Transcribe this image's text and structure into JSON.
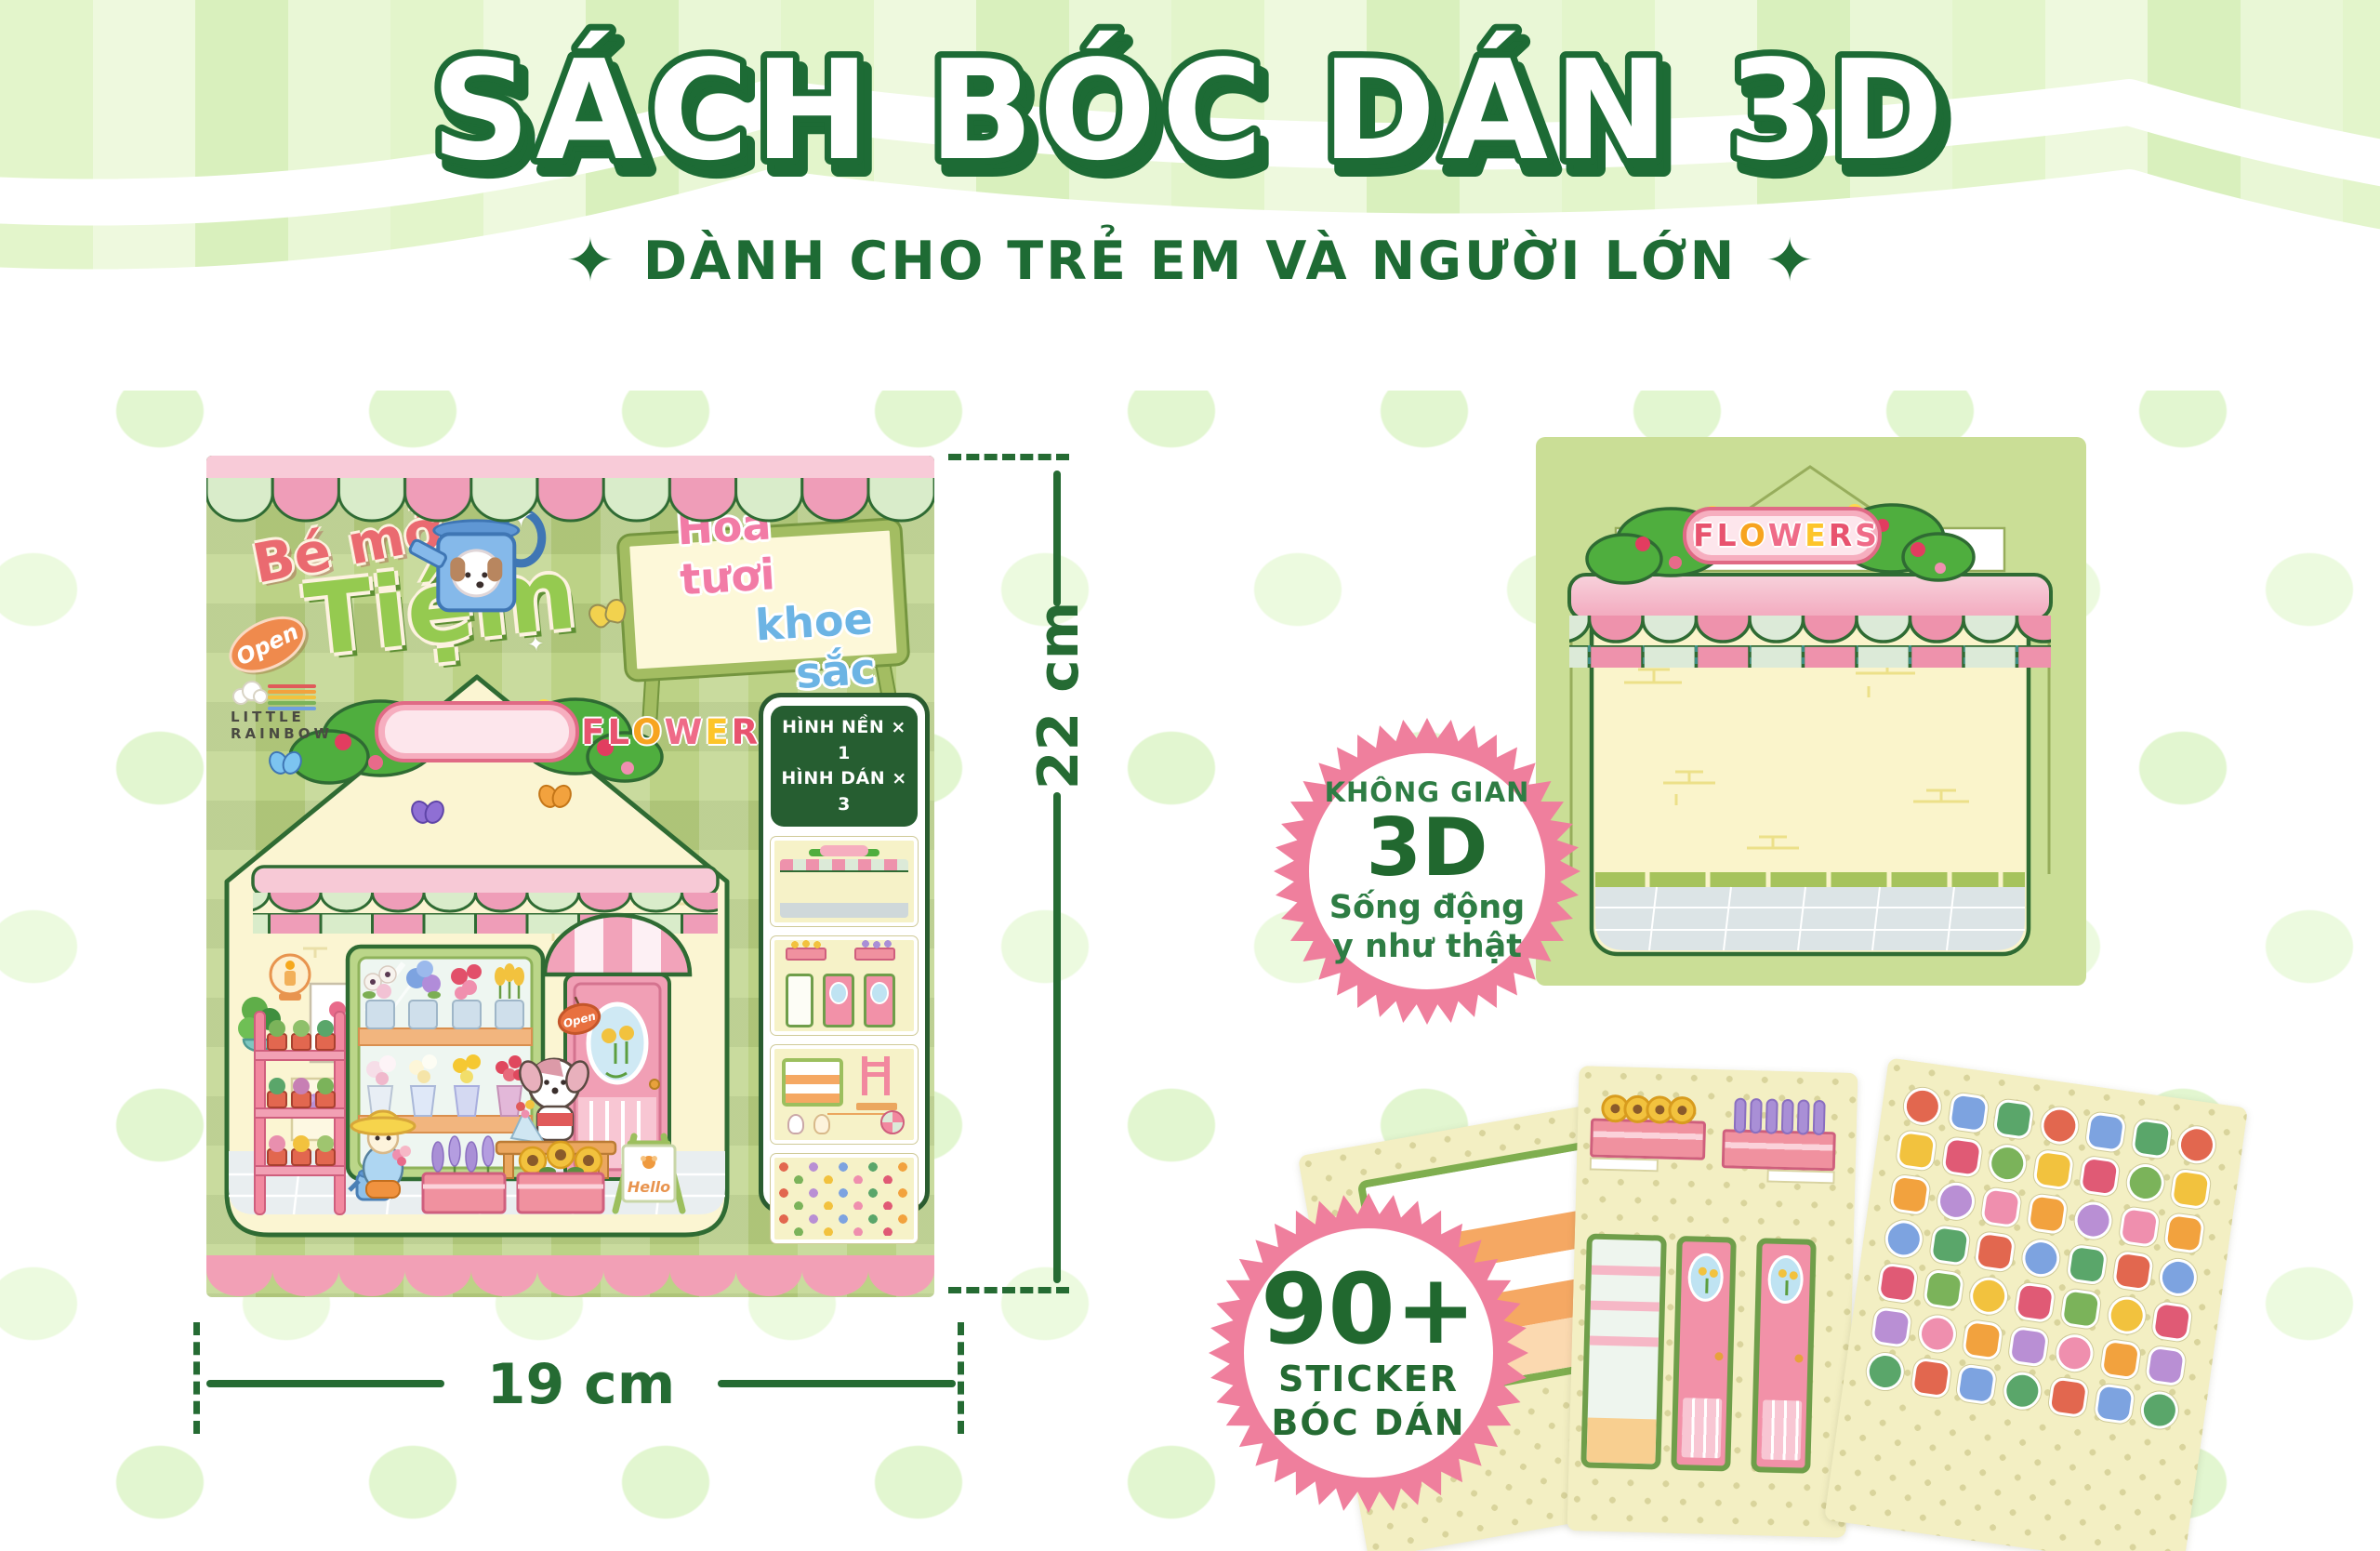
{
  "header": {
    "title": "SÁCH BÓC DÁN 3D",
    "subtitle": "DÀNH CHO TRẺ EM VÀ NGƯỜI LỚN",
    "sparkle": "✦"
  },
  "cover": {
    "brand": "LITTLE RAINBOW",
    "logo": {
      "line1": "Bé mở",
      "badge": "Open",
      "line2": "Tiệm"
    },
    "board": {
      "line1": "Hoa tươi",
      "line2": "khoe sắc"
    },
    "shop_sign": "FLOWERS",
    "contents": {
      "line1": "HÌNH NỀN × 1",
      "line2": "HÌNH DÁN × 3"
    },
    "door_tag": "Open",
    "easel": "Hello",
    "poster_tag": "Sale"
  },
  "dimensions": {
    "height": "22 cm",
    "width": "19 cm"
  },
  "backdrop": {
    "shop_sign": "FLOWERS"
  },
  "badges": {
    "space": {
      "line1": "KHÔNG GIAN",
      "line2": "3D",
      "line3": "Sống động",
      "line4": "y như thật"
    },
    "stickers": {
      "count": "90+",
      "line1": "STICKER",
      "line2": "BÓC DÁN"
    }
  },
  "flowers_letters": [
    {
      "ch": "F",
      "c": "#e8536f"
    },
    {
      "ch": "L",
      "c": "#e8536f"
    },
    {
      "ch": "O",
      "c": "#f7a41f"
    },
    {
      "ch": "W",
      "c": "#ef6b88"
    },
    {
      "ch": "E",
      "c": "#fdc52a"
    },
    {
      "ch": "R",
      "c": "#e8536f"
    },
    {
      "ch": "S",
      "c": "#ef6b88"
    }
  ],
  "colors": {
    "accent_green": "#1d6b35",
    "dim_green": "#256b33",
    "badge_pink": "#ef7f9d",
    "awning_pink": "#ee92ac",
    "awning_mint": "#d9ecca",
    "sticker_palette": [
      "#e2674f",
      "#7bb35a",
      "#b98fd4",
      "#7da3e0",
      "#f2c23e",
      "#ef8fae",
      "#5aa66a",
      "#e05a75",
      "#f2a23e"
    ]
  }
}
